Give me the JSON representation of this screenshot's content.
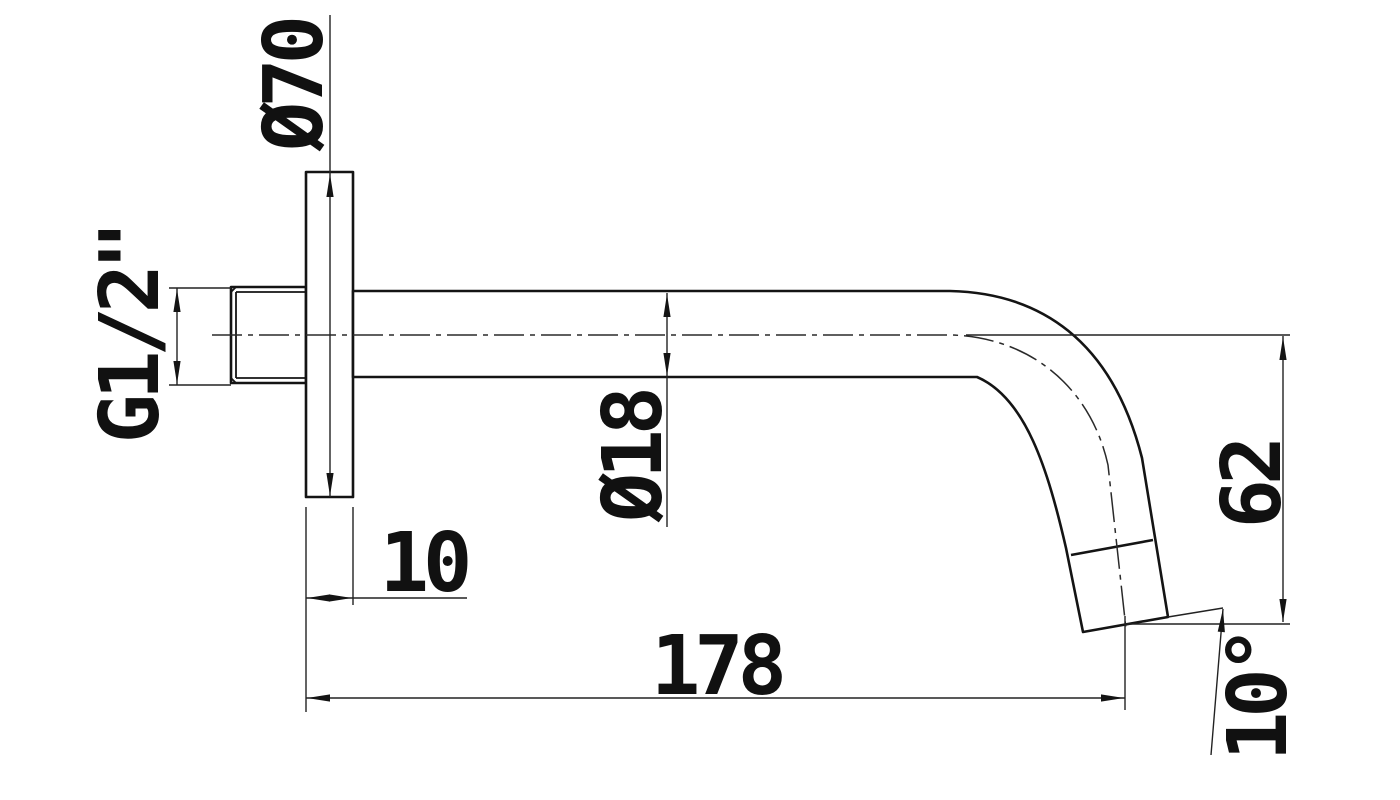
{
  "drawing": {
    "type": "technical-dimension-drawing",
    "subject": "wall-mounted-spout-side-view",
    "background_color": "#ffffff",
    "line_color": "#141414",
    "labels": {
      "flange_diameter": "Ø70",
      "thread_size": "G1/2\"",
      "tube_diameter": "Ø18",
      "flange_thickness": "10",
      "projection_length": "178",
      "drop_height": "62",
      "outlet_angle": "10°"
    }
  }
}
